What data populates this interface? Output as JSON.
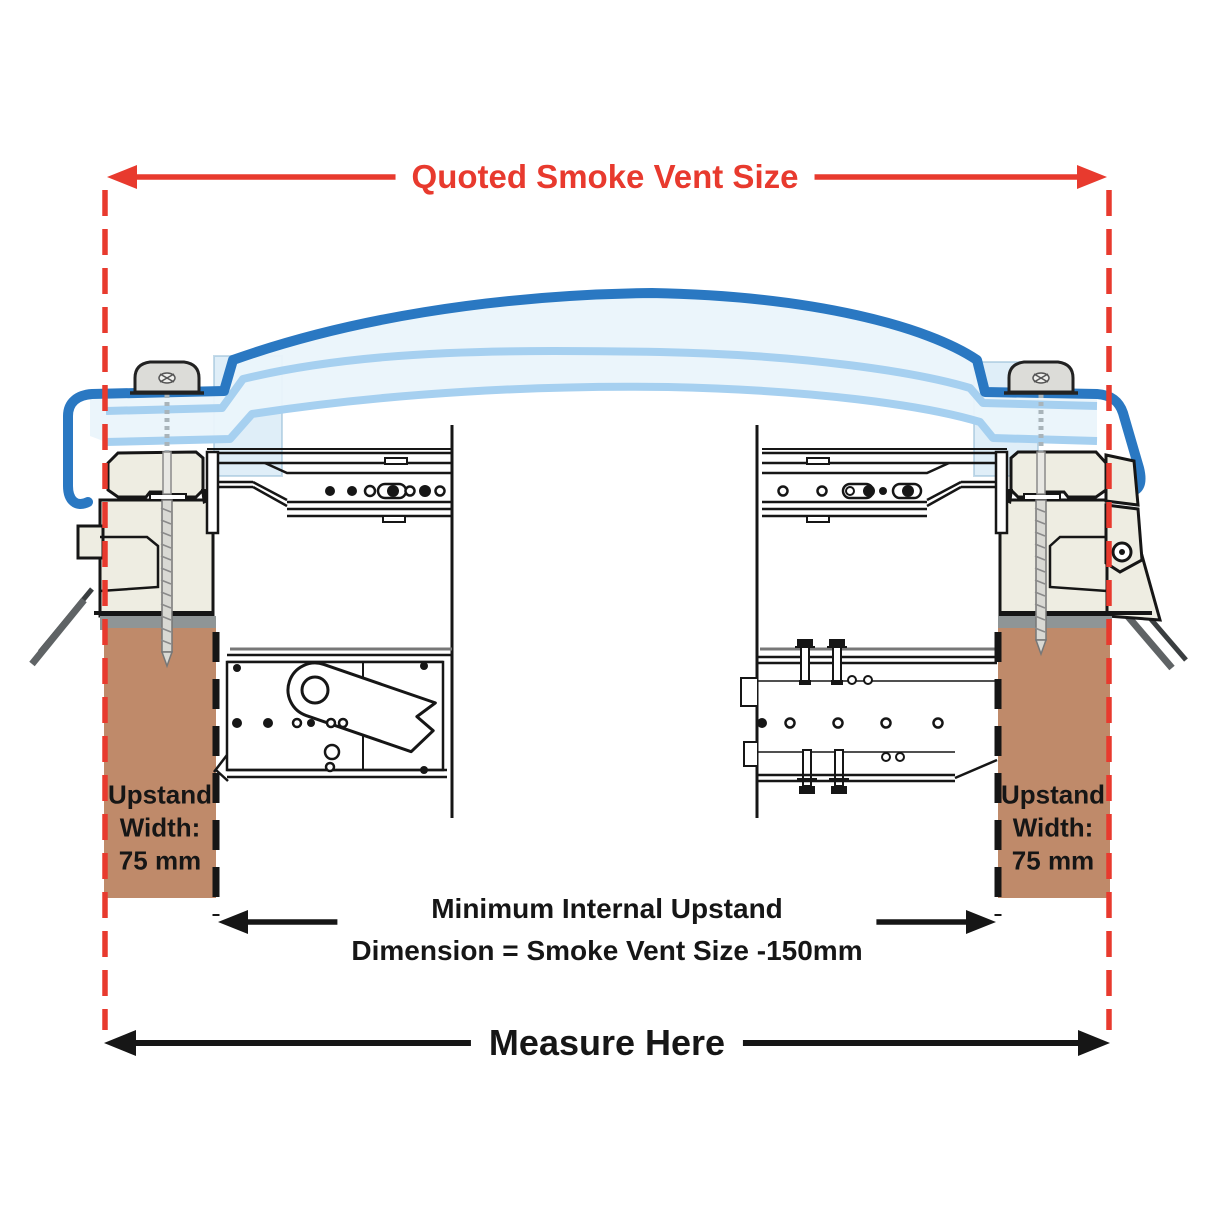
{
  "diagram": {
    "top_dimension_label": "Quoted Smoke Vent Size",
    "internal_dimension_label_line1": "Minimum Internal Upstand",
    "internal_dimension_label_line2": "Dimension = Smoke Vent Size -150mm",
    "bottom_dimension_label": "Measure Here",
    "left_upstand": {
      "line1": "Upstand",
      "line2": "Width:",
      "line3": "75 mm"
    },
    "right_upstand": {
      "line1": "Upstand",
      "line2": "Width:",
      "line3": "75 mm"
    }
  },
  "colors": {
    "dimension_red": "#e83a2e",
    "dome_outer_blue": "#2a78c2",
    "glazing_light_blue": "#a6d0f0",
    "glazing_pale_fill": "#eaf4fb",
    "frame_cream": "#eeede2",
    "upstand_brown": "#bf8a6a",
    "mortar_grey": "#8f9596",
    "flashing_grey": "#5f6365",
    "line_black": "#161616",
    "text_black": "#161616"
  }
}
